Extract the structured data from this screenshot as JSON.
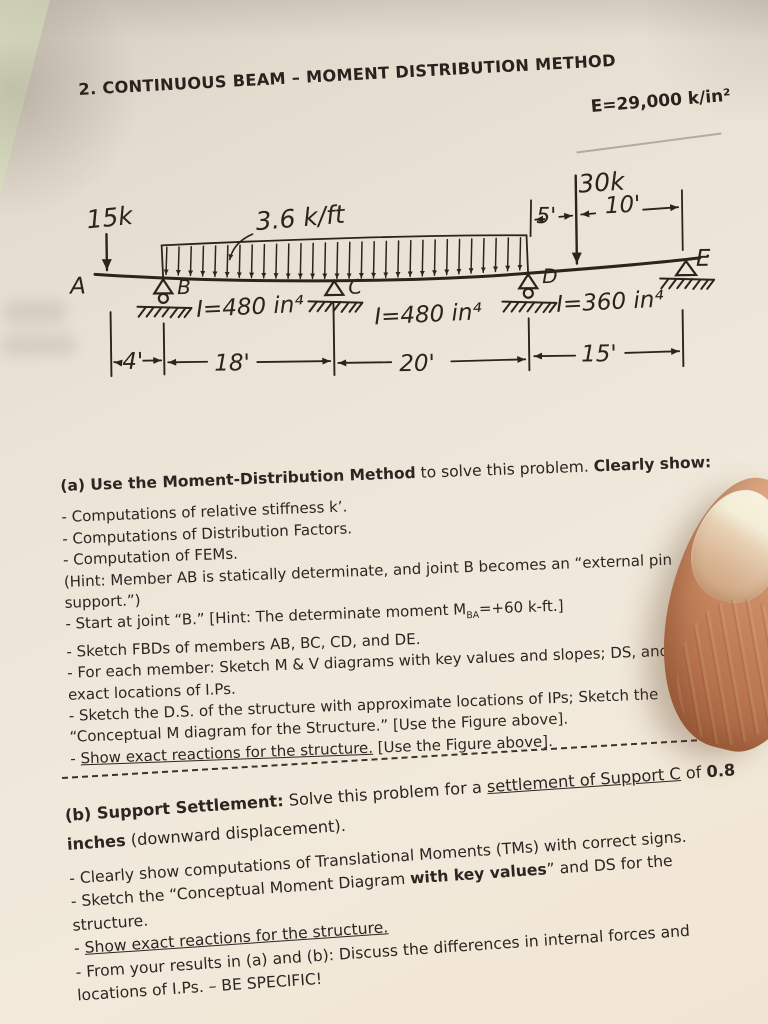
{
  "header": {
    "problem_title": "2. CONTINUOUS BEAM – MOMENT DISTRIBUTION METHOD",
    "modulus": "E=29,000 k/in²"
  },
  "diagram": {
    "point_load_left": "15k",
    "udl_label": "3.6 k/ft",
    "point_load_right": "30k",
    "dim_d_to_load": "5'",
    "dim_load_to_e": "10'",
    "node_a": "A",
    "node_b": "B",
    "node_c": "C",
    "node_d": "D",
    "node_e": "E",
    "inertia_bc": "I=480 in⁴",
    "inertia_cd": "I=480 in⁴",
    "inertia_de": "I=360 in⁴",
    "dim_ab": "4'",
    "dim_bc": "18'",
    "dim_cd": "20'",
    "dim_de": "15'"
  },
  "part_a": {
    "heading": {
      "b1": "(a) Use the Moment-Distribution Method",
      "t1": " to solve this problem. ",
      "b2": "Clearly show:"
    },
    "item1": "- Computations of relative stiffness k’.",
    "item2": "- Computations of Distribution Factors.",
    "item3": "- Computation of FEMs.",
    "item4_line1": "(Hint: Member AB is statically determinate, and joint B becomes an “external pin",
    "item4_line2": "support.”)",
    "item5": {
      "t1": "- Start at joint “B.” [Hint: The determinate moment M",
      "sub": "BA",
      "t2": "=+60 k-ft.]"
    },
    "item6": "- Sketch FBDs of members AB, BC, CD, and DE.",
    "item7_line1": "- For each member: Sketch M & V diagrams with key values and slopes; DS, and",
    "item7_line2": "exact locations of I.Ps.",
    "item8_line1": "- Sketch the D.S. of the structure with approximate locations of IPs; Sketch the",
    "item8_line2": "“Conceptual M diagram for the Structure.” [Use the Figure above].",
    "item9": {
      "t1": "- ",
      "u1": "Show exact reactions for the structure.",
      "t2": " [Use the Figure above]."
    }
  },
  "part_b": {
    "heading": {
      "b1": "(b) Support Settlement:",
      "t1": " Solve this problem for a ",
      "u1": "settlement of Support C",
      "t2": " of ",
      "b2": "0.8",
      "b3": "inches",
      "t3": " (downward displacement)."
    },
    "item1": "- Clearly show computations of Translational Moments (TMs) with correct signs.",
    "item2": {
      "t1": "- Sketch the “Conceptual Moment Diagram ",
      "b1": "with key values",
      "t2": "” and DS for the"
    },
    "item2_line2": "structure.",
    "item3": {
      "t1": "- ",
      "u1": "Show exact reactions for the structure."
    },
    "item4_line1": "- From your results in (a) and (b): Discuss the differences in internal forces and",
    "item4_line2": "locations of I.Ps. – BE SPECIFIC!"
  }
}
